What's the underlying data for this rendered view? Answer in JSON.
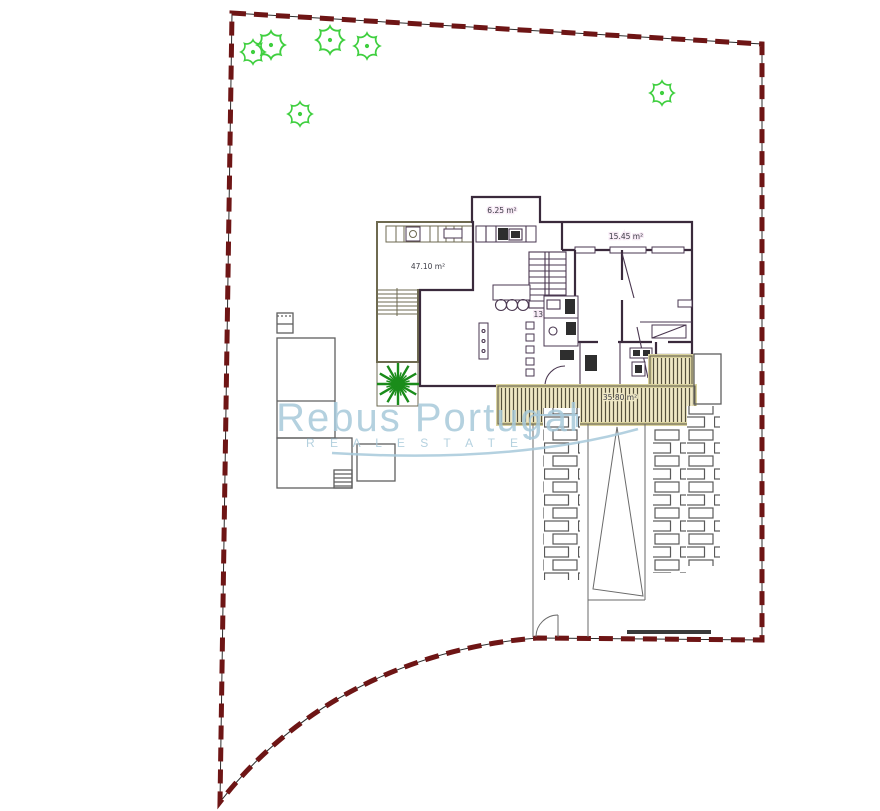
{
  "drawing": {
    "watermark": {
      "brand": "Rebus Portugal",
      "tagline": "R E A L   E S T A T E"
    },
    "area_labels": {
      "top_room": "6.25 m²",
      "right_room": "15.45 m²",
      "terrace": "47.10 m²",
      "interior": "135.00 m²",
      "deck": "35.80 m²"
    },
    "colors": {
      "boundary": "#6e1515",
      "tree": "#3fcf3f",
      "palm": "#1a8c1a",
      "purple_fill": "#f6e0f4",
      "purple_hatch": "#a257a2",
      "wall": "#3a2a3c",
      "yellow_fill": "#f8f3d9",
      "yellow_hatch": "#d9cfa2",
      "deck_fill": "#efe8c5",
      "deck_stripe": "#55503c",
      "neighbor_line": "#5f5f5f",
      "watermark_blue": "#a7c9da",
      "label_text": "#3c3c46"
    }
  }
}
